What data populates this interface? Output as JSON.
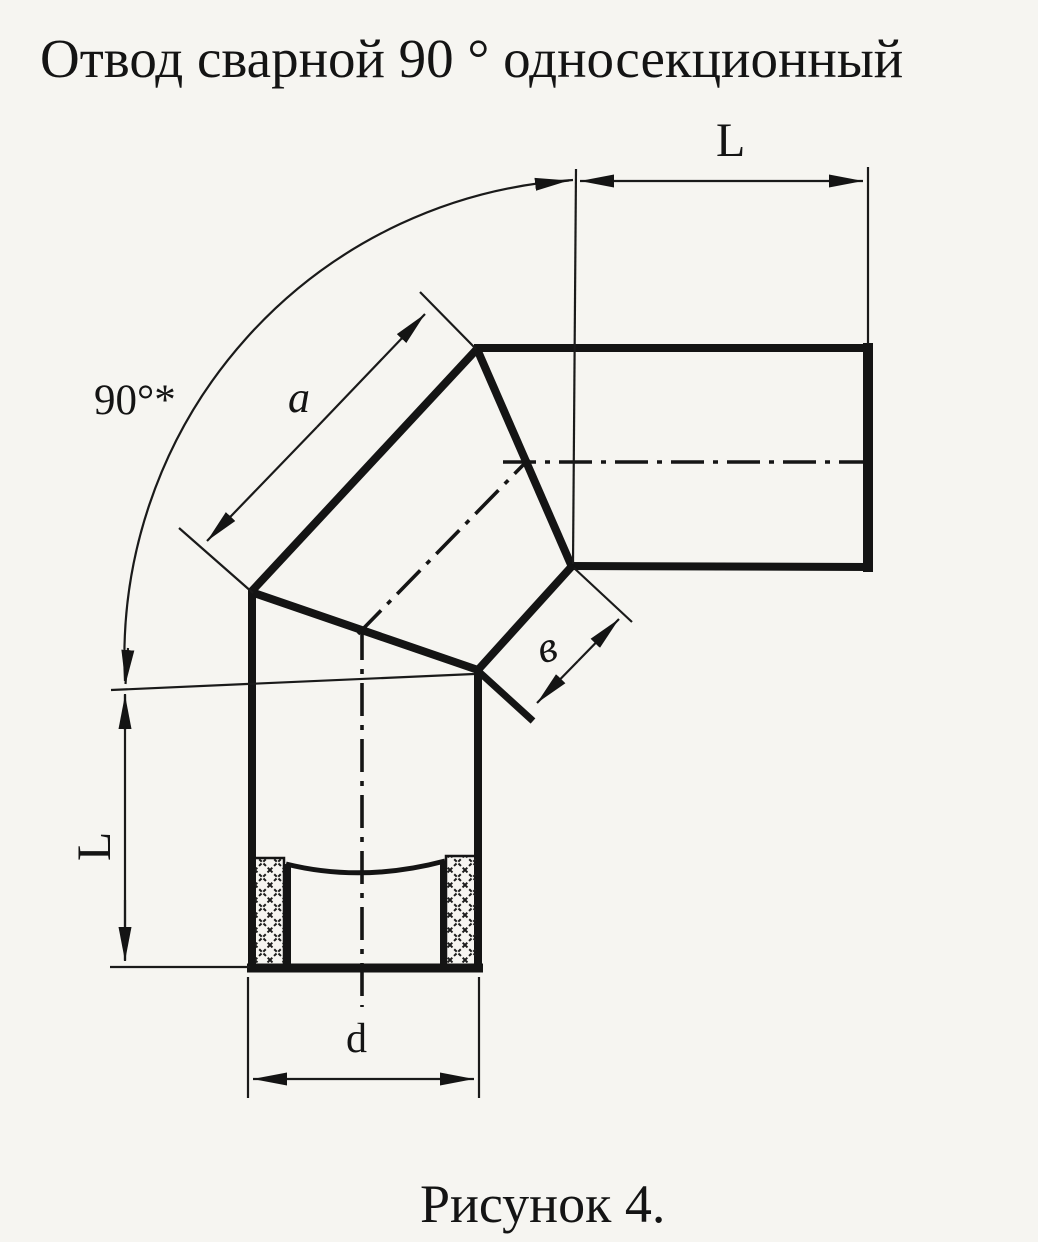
{
  "title": "Отвод сварной 90 ° односекционный",
  "caption": "Рисунок 4.",
  "dimensions": {
    "angle_label": "90°*",
    "top_length_label": "L",
    "left_length_label": "L",
    "segment_outer_side_label": "a",
    "segment_narrow_side_label": "в",
    "diameter_label": "d"
  },
  "drawing": {
    "type": "technical-drawing",
    "subject": "welded 90 degree single-section pipe elbow",
    "views": [
      "side elevation with socket section"
    ],
    "figure_number": "4"
  },
  "colors": {
    "ink": "#141414",
    "paper": "#f6f5f1"
  }
}
